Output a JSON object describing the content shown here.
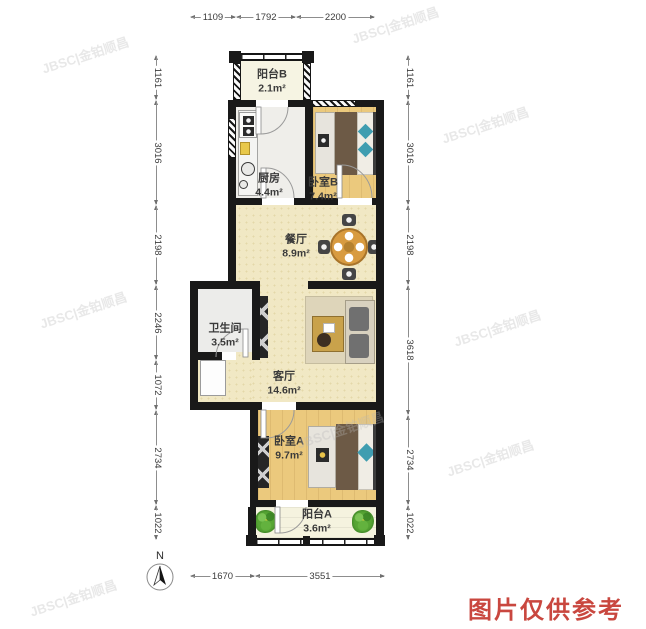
{
  "plan": {
    "rooms": {
      "balcony_b": {
        "name": "阳台B",
        "area": "2.1m²"
      },
      "kitchen": {
        "name": "厨房",
        "area": "4.4m²"
      },
      "bedroom_b": {
        "name": "卧室B",
        "area": "7.4m²"
      },
      "dining": {
        "name": "餐厅",
        "area": "8.9m²"
      },
      "bathroom": {
        "name": "卫生间",
        "area": "3.5m²"
      },
      "living": {
        "name": "客厅",
        "area": "14.6m²"
      },
      "bedroom_a": {
        "name": "卧室A",
        "area": "9.7m²"
      },
      "balcony_a": {
        "name": "阳台A",
        "area": "3.6m²"
      }
    }
  },
  "dims": {
    "top": [
      "1109",
      "1792",
      "2200"
    ],
    "left": [
      "1161",
      "3016",
      "2198",
      "2246",
      "1072",
      "2734",
      "1022"
    ],
    "right": [
      "1161",
      "3016",
      "2198",
      "3618",
      "2734",
      "1022"
    ],
    "bottom": [
      "1670",
      "3551"
    ]
  },
  "compass": {
    "label": "N"
  },
  "watermark": {
    "text": "JBSC|金铂顺昌"
  },
  "disclaimer": {
    "text": "图片仅供参考"
  },
  "colors": {
    "wall": "#191919",
    "wood_floor": "#ebc97d",
    "cream_floor": "#f1e8c4",
    "teal_accent": "#3f9db0",
    "dining_table": "#d89b40",
    "plant_green": "#57a635",
    "disclaimer_red": "#c9473f"
  }
}
